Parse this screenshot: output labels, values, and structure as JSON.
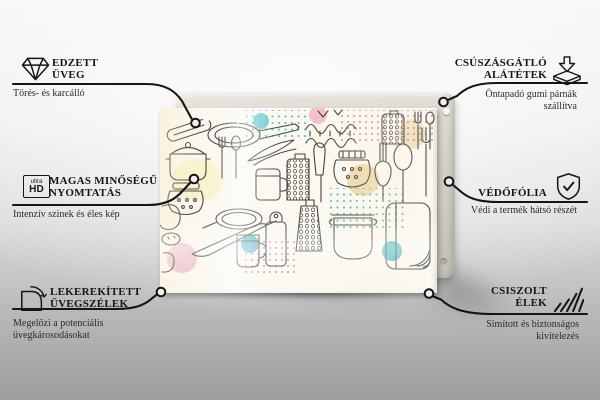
{
  "product": {
    "photo_alt": "Üveg vágódeszka konyhai eszköz mintával",
    "pattern_style": "kitchen utensil doodles"
  },
  "features": {
    "left": [
      {
        "id": "tempered-glass",
        "icon": "diamond-icon",
        "title_lines": [
          "EDZETT",
          "ÜVEG"
        ],
        "subtitle": "Törés- és karcálló"
      },
      {
        "id": "high-quality-print",
        "icon": "ultra-hd-icon",
        "icon_text": {
          "top": "ultra",
          "bottom": "HD"
        },
        "title_lines": [
          "MAGAS MINŐSÉGŰ",
          "NYOMTATÁS"
        ],
        "subtitle": "Intenzív szinek és éles kép"
      },
      {
        "id": "rounded-glass-edges",
        "icon": "rounded-corner-icon",
        "title_lines": [
          "LEKEREKÍTETT",
          "ÜVEGSZÉLEK"
        ],
        "subtitle": "Megelőzi a potenciális üvegkárosodásokat"
      }
    ],
    "right": [
      {
        "id": "anti-slip-pads",
        "icon": "anti-slip-pad-icon",
        "title_lines": [
          "CSÚSZÁSGÁTLÓ",
          "ALÁTÉTEK"
        ],
        "subtitle": "Öntapadó gumi párnák szállítva"
      },
      {
        "id": "protective-film",
        "icon": "shield-check-icon",
        "title_lines": [
          "VÉDŐFÓLIA"
        ],
        "subtitle": "Védi a termék hátsó részét"
      },
      {
        "id": "polished-edges",
        "icon": "hatched-edges-icon",
        "title_lines": [
          "CSISZOLT",
          "ÉLEK"
        ],
        "subtitle": "Simított és biztonságos kivitelezés"
      }
    ]
  },
  "colors": {
    "line": "#151515",
    "accent_teal": "#49b9c4",
    "accent_pink": "#f0c3ce",
    "accent_yellow": "#f8f3cf",
    "accent_tan": "#eed9ab",
    "backing_grey": "#d6d2c8"
  }
}
